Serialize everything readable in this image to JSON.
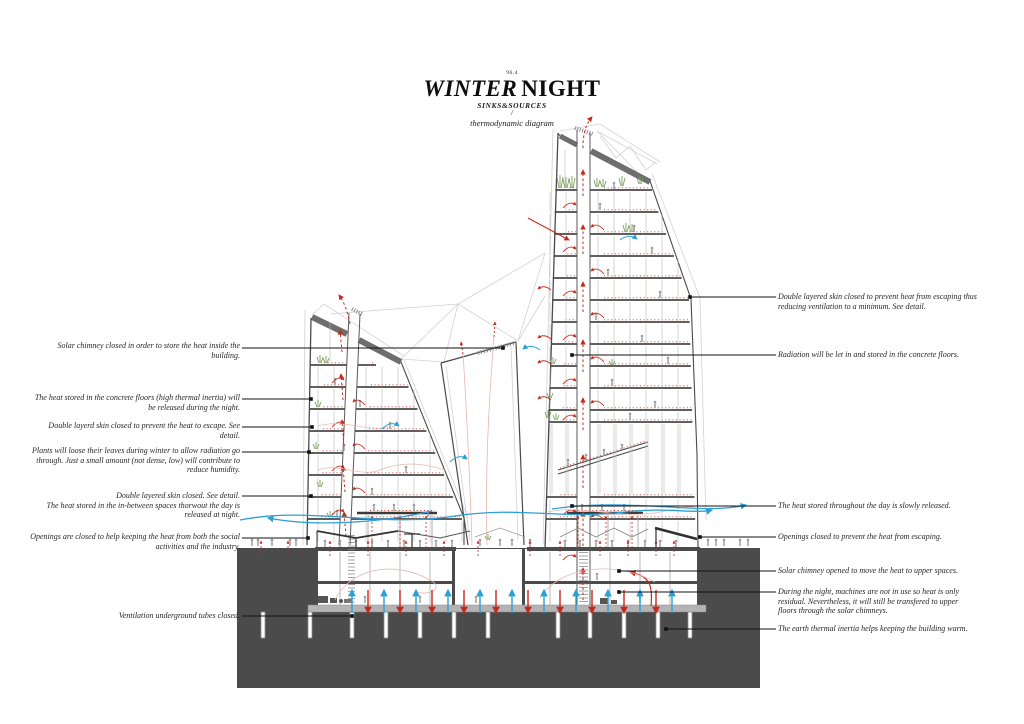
{
  "title": {
    "number": "96.4",
    "main_italic": "WINTER",
    "main_regular": "NIGHT",
    "subtitle": "SINKS&SOURCES",
    "divider": "/",
    "caption": "thermodynamic diagram"
  },
  "left_annotations": [
    "Solar chimney closed in order to store the heat inside the building.",
    "The heat stored in the concrete floors (high thermal inertia) will be released during the night.",
    "Double layerd skin closed to prevent the heat to escape. See detail.",
    "Plants will loose their leaves during winter to allow radiation go through. Just a small amount (not dense, low) will contribute to reduce humidity.",
    "Double layered skin closed. See detail.\nThe heat stored in the in-between spaces thorwout the day is released at night.",
    "Openings are closed to help keeping the heat from both the social activities and the industry.",
    "Ventilation underground tubes closed."
  ],
  "right_annotations": [
    "Double layered skin closed to prevent heat from escaping thus reducing ventilation to a minimum. See detail.",
    "Radiation will be let in and stored in the concrete floors.",
    "The heat stored throughout the day is slowly released.",
    "Openings closed to prevent the heat from escaping.",
    "Solar chimney opened to move the heat to upper spaces.",
    "During the night, machines are not in use so heat is only residual. Nevertheless, it will still be transfered to upper floors through the solar chimneys.",
    "The earth thermal inertia helps keeping the building warm."
  ],
  "colors": {
    "ink": "#1a1a1a",
    "dark": "#4a4a4a",
    "band": "#6e6e6e",
    "ground": "#4b4b4b",
    "slab": "#b4b4b4",
    "mid": "#8a8a8a",
    "light": "#b5b5b5",
    "ghost": "#d2d2d2",
    "red": "#c5281c",
    "redlight": "#e9b6b0",
    "blue": "#2d9fd6",
    "green": "#7d9e5f",
    "figure": "#9c9c9c"
  }
}
